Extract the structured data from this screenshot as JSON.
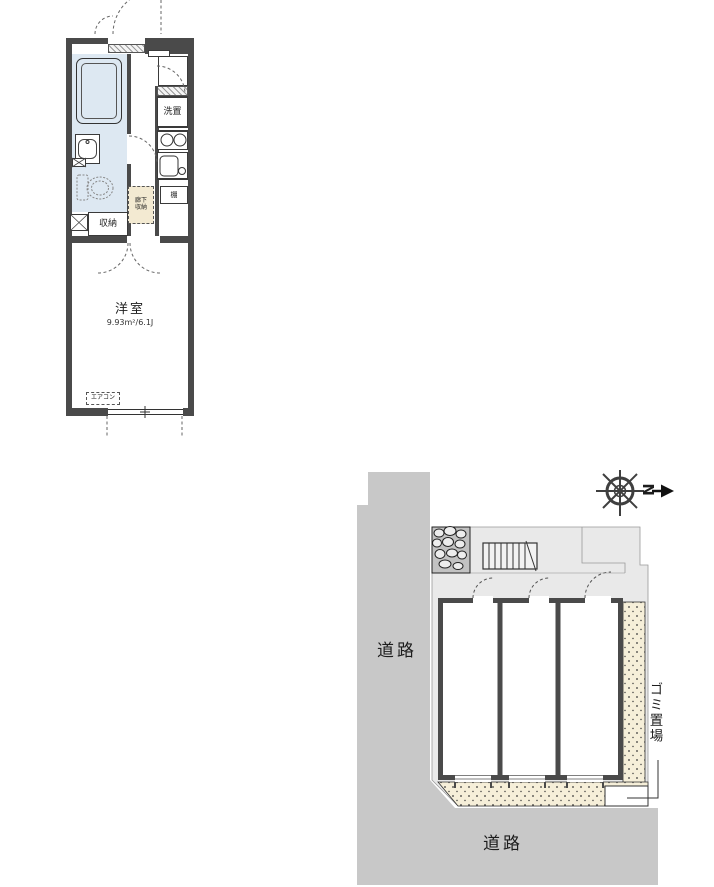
{
  "floor_plan": {
    "room_label": "洋室",
    "room_size": "9.93m²/6.1J",
    "storage_label": "収納",
    "hall_storage_label": "廊下収納",
    "shelf_label": "棚",
    "laundry_label": "洗置",
    "aircon_label": "エアコン"
  },
  "site_plan": {
    "road_left_label": "道路",
    "road_bottom_label": "道路",
    "garbage_area_label": "ゴミ置場",
    "compass_north_label": "N"
  },
  "colors": {
    "wall": "#4a4a4a",
    "room_blue": "#dde8f2",
    "closet_cream": "#f3ead2",
    "road_gray": "#c8c8c8",
    "lot_gray": "#e9e9e9",
    "walkway_beige": "#f6efd9"
  }
}
